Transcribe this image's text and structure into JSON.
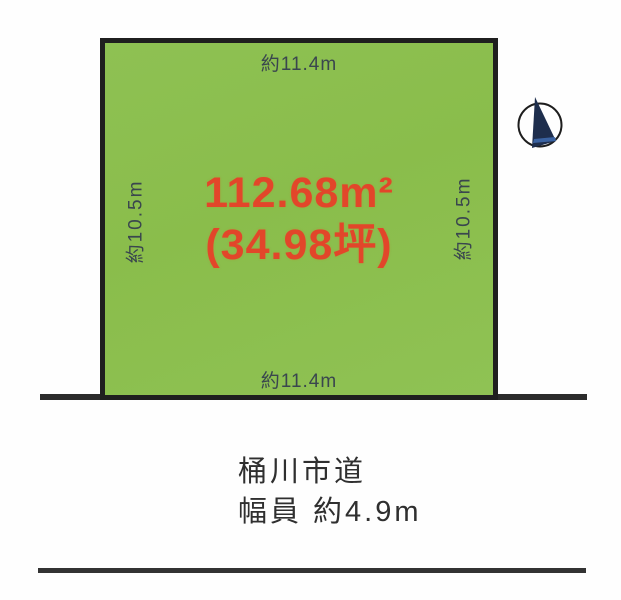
{
  "diagram": {
    "plot": {
      "area_m2": "112.68m²",
      "area_tsubo": "(34.98坪)",
      "dim_top": "約11.4m",
      "dim_bottom": "約11.4m",
      "dim_left": "約10.5m",
      "dim_right": "約10.5m"
    },
    "road": {
      "name": "桶川市道",
      "width": "幅員 約4.9m"
    },
    "icons": {
      "north_arrow": "north-arrow-compass"
    },
    "colors": {
      "plot_fill": "#8bc04e",
      "plot_border": "#1f1f1f",
      "area_text": "#e2462a",
      "dimension_text": "#3a464e",
      "road_line": "#2b2b2b",
      "compass_needle": "#1e2e4d",
      "compass_needle_accent": "#3f6bb0"
    }
  }
}
